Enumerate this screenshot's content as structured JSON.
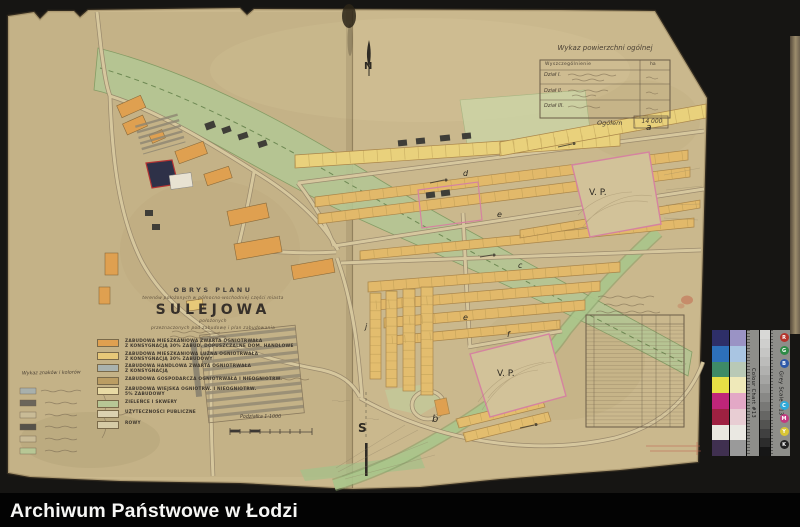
{
  "archive": {
    "footer_title": "Archiwum Państwowe w Łodzi"
  },
  "map": {
    "title_block": {
      "heading": "OBRYS PLANU",
      "subtitle1": "terenów położonych w północno-wschodniej części miasta",
      "town": "SULEJOWA",
      "subtitle2": "położonych",
      "subtitle3": "przeznaczonych pod zabudowę i plan zabudowania"
    },
    "legend": {
      "items": [
        {
          "color": "#dfa050",
          "lines": [
            "ZABUDOWA MIESZKANIOWA ZWARTA OGNIOTRWAŁA",
            "Z KONSYGNACJĄ 30% ZABUD. DOPUSZCZALNE DOM. HANDLOWE"
          ]
        },
        {
          "color": "#e7c878",
          "lines": [
            "ZABUDOWA MIESZKANIOWA LUŹNA OGNIOTRWAŁA",
            "Z KONSYGNACJĄ 30% ZABUDOWY"
          ]
        },
        {
          "color": "#a9b2ae",
          "lines": [
            "ZABUDOWA HANDLOWA ZWARTA OGNIOTRWAŁA",
            "Z KONSYGNACJĄ"
          ]
        },
        {
          "color": "#bb9d63",
          "lines": [
            "ZABUDOWA GOSPODARCZA OGNIOTRWAŁA I NIEOGNIOTRW."
          ]
        },
        {
          "color": "#e8daa4",
          "lines": [
            "ZABUDOWA WIEJSKA OGNIOTRW. I NIEOGNIOTRW.",
            "5% ZABUDOWY"
          ]
        },
        {
          "color": "#b7c795",
          "lines": [
            "ZIELEŃCE I SKWERY"
          ]
        },
        {
          "color": "#dbd1b0",
          "lines": [
            "UŻYTECZNOŚCI PUBLICZNE"
          ]
        },
        {
          "color": "#d6cba6",
          "lines": [
            "ROWY"
          ]
        }
      ]
    },
    "scale_label": "Podziałka 1:1000",
    "mini_legend_title": "Wykaz znaków i kolorów",
    "area_table": {
      "title": "Wykaz powierzchni ogólnej",
      "header": "Wyszczególnienie",
      "unit": "ha",
      "rows": [
        "Dział I.",
        "Dział II.",
        "Dział III."
      ],
      "total_label": "Ogółem",
      "total_value": "14 000"
    },
    "detail_table": {
      "legible": false,
      "rows": 26
    },
    "labels": [
      {
        "id": "n",
        "text": "N",
        "x": 364,
        "y": 61,
        "size": 10,
        "bold": true
      },
      {
        "id": "s",
        "text": "S",
        "x": 358,
        "y": 421,
        "size": 12,
        "bold": true
      },
      {
        "id": "vp1",
        "text": "V. P.",
        "x": 589,
        "y": 188,
        "size": 9
      },
      {
        "id": "vp2",
        "text": "V. P.",
        "x": 497,
        "y": 369,
        "size": 9
      },
      {
        "id": "a",
        "text": "a",
        "x": 646,
        "y": 123,
        "size": 9,
        "italic": true
      },
      {
        "id": "b",
        "text": "b",
        "x": 432,
        "y": 414,
        "size": 10,
        "italic": true
      },
      {
        "id": "c",
        "text": "c",
        "x": 518,
        "y": 261,
        "size": 8,
        "italic": true
      },
      {
        "id": "d",
        "text": "d",
        "x": 463,
        "y": 169,
        "size": 8,
        "italic": true
      },
      {
        "id": "e",
        "text": "e",
        "x": 497,
        "y": 210,
        "size": 8,
        "italic": true
      },
      {
        "id": "e2",
        "text": "e",
        "x": 463,
        "y": 313,
        "size": 8,
        "italic": true
      },
      {
        "id": "f",
        "text": "f",
        "x": 507,
        "y": 330,
        "size": 8,
        "italic": true
      },
      {
        "id": "j",
        "text": "j",
        "x": 365,
        "y": 322,
        "size": 8,
        "italic": true
      }
    ]
  },
  "calibration": {
    "colour_chart_label": "Colour Chart #13",
    "grey_scale_label": "Grey Scale #13",
    "column1": [
      "#2e2f68",
      "#2d70ba",
      "#3e8a66",
      "#e6df45",
      "#bf2579",
      "#9e2141",
      "#e9e7df",
      "#403050"
    ],
    "column2": [
      "#9a93c5",
      "#a9c5e2",
      "#b9c9b6",
      "#efe9b9",
      "#e3a8c6",
      "#e8cdd3",
      "#eae8e2",
      "#9a9a9a"
    ],
    "grays": [
      "#d8d8d6",
      "#cfcfcd",
      "#c6c6c4",
      "#bcbcba",
      "#b1b1af",
      "#a5a5a3",
      "#979795",
      "#888886",
      "#787876",
      "#666664",
      "#535351",
      "#404040",
      "#2c2c2c",
      "#161616"
    ],
    "dots_top": [
      {
        "label": "R",
        "color": "#b5342c"
      },
      {
        "label": "G",
        "color": "#2e8b46"
      },
      {
        "label": "B",
        "color": "#2d58a8"
      }
    ],
    "dots_bottom": [
      {
        "label": "C",
        "color": "#2fa9d8"
      },
      {
        "label": "M",
        "color": "#c23a80"
      },
      {
        "label": "Y",
        "color": "#d8c535"
      },
      {
        "label": "K",
        "color": "#222222"
      }
    ]
  }
}
